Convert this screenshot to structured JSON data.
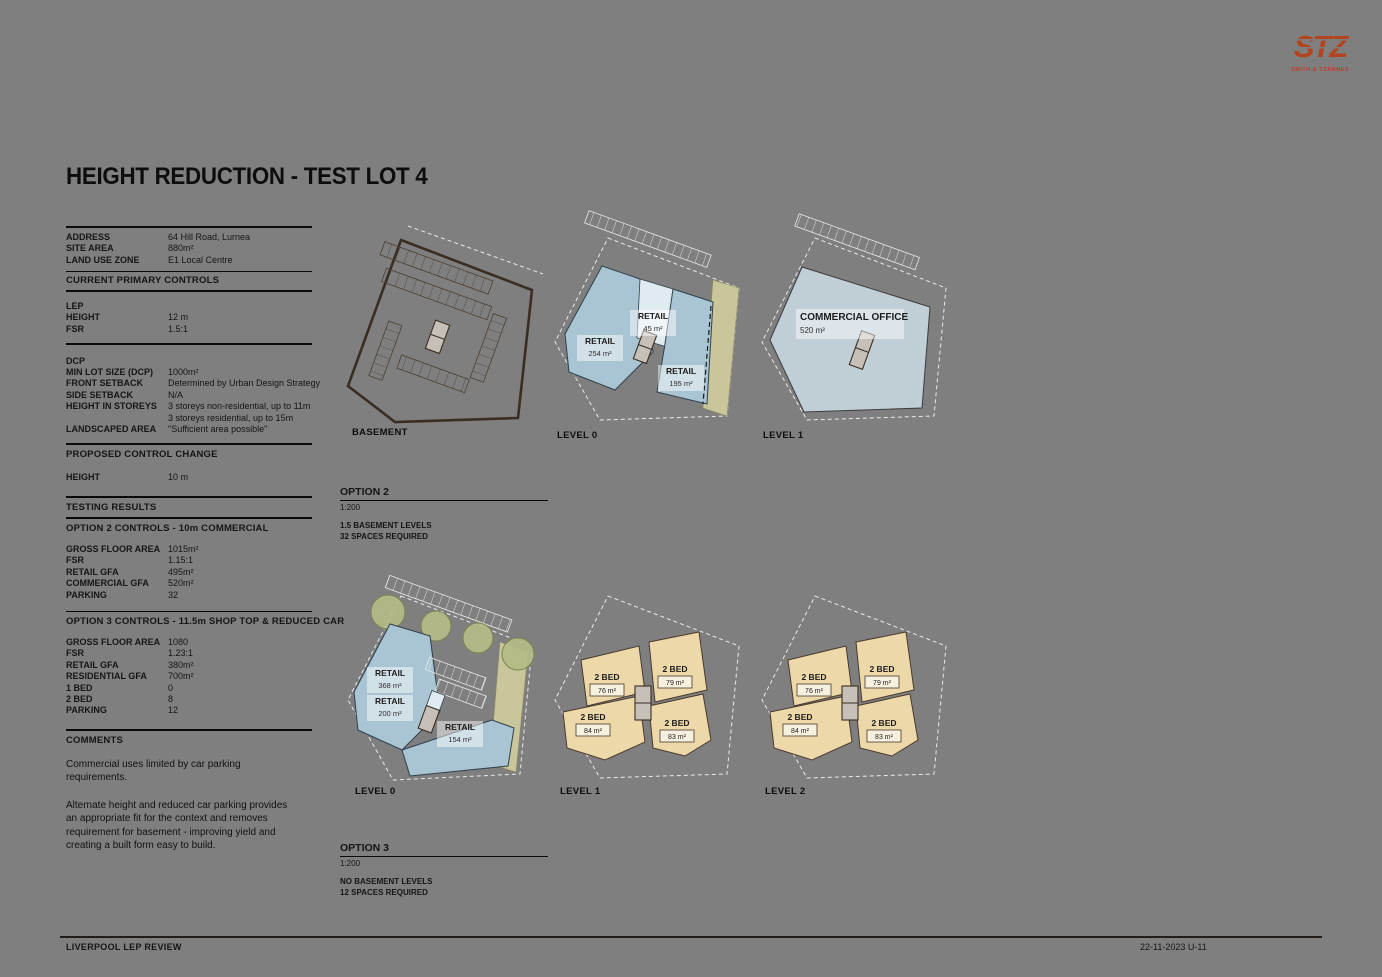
{
  "title": "HEIGHT REDUCTION - TEST LOT 4",
  "logo": {
    "mark": "STZ",
    "subtext": "SMITH & TZANNES"
  },
  "site_details": {
    "rows": [
      {
        "label": "ADDRESS",
        "value": "64 Hill Road, Lurnea"
      },
      {
        "label": "SITE AREA",
        "value": "880m²"
      },
      {
        "label": "LAND USE ZONE",
        "value": "E1 Local Centre"
      }
    ]
  },
  "current_controls": {
    "heading": "CURRENT PRIMARY CONTROLS",
    "lep_heading": "LEP",
    "lep_rows": [
      {
        "label": "HEIGHT",
        "value": "12 m"
      },
      {
        "label": "FSR",
        "value": "1.5:1"
      }
    ],
    "dcp_heading": "DCP",
    "dcp_rows": [
      {
        "label": "MIN LOT SIZE (DCP)",
        "value": "1000m²"
      },
      {
        "label": "FRONT SETBACK",
        "value": "Determined by Urban Design Strategy"
      },
      {
        "label": "SIDE SETBACK",
        "value": "N/A"
      },
      {
        "label": "HEIGHT IN STOREYS",
        "value": "3 storeys non-residential, up to 11m"
      },
      {
        "label": "",
        "value": "3 storeys residential, up to 15m"
      },
      {
        "label": "LANDSCAPED AREA",
        "value": "\"Sufficient area possible\""
      }
    ]
  },
  "proposed_change": {
    "heading": "PROPOSED CONTROL CHANGE",
    "rows": [
      {
        "label": "HEIGHT",
        "value": "10 m"
      }
    ]
  },
  "testing_results_heading": "TESTING RESULTS",
  "option2_controls": {
    "heading": "OPTION 2 CONTROLS - 10m COMMERCIAL",
    "rows": [
      {
        "label": "GROSS FLOOR AREA",
        "value": "1015m²"
      },
      {
        "label": "FSR",
        "value": "1.15:1"
      },
      {
        "label": "RETAIL GFA",
        "value": "495m²"
      },
      {
        "label": "COMMERCIAL GFA",
        "value": "520m²"
      },
      {
        "label": "PARKING",
        "value": "32"
      }
    ]
  },
  "option3_controls": {
    "heading": "OPTION 3 CONTROLS - 11.5m SHOP TOP & REDUCED CAR",
    "rows": [
      {
        "label": "GROSS FLOOR AREA",
        "value": "1080"
      },
      {
        "label": "FSR",
        "value": "1.23:1"
      },
      {
        "label": "RETAIL GFA",
        "value": "380m²"
      },
      {
        "label": "RESIDENTIAL GFA",
        "value": "700m²"
      },
      {
        "label": "1 BED",
        "value": "0"
      },
      {
        "label": "2 BED",
        "value": "8"
      },
      {
        "label": "PARKING",
        "value": "12"
      }
    ]
  },
  "comments": {
    "heading": "COMMENTS",
    "p1": "Commercial uses limited by car parking requirements.",
    "p2": "Alternate height and reduced car parking provides an appropriate fit for the context and removes requirement for basement - improving yield and creating a built form easy to build."
  },
  "option2_plans": {
    "title": "OPTION 2",
    "scale": "1:200",
    "note1": "1.5 BASEMENT LEVELS",
    "note2": "32 SPACES REQUIRED",
    "basement_label": "BASEMENT",
    "level0_label": "LEVEL 0",
    "level1_label": "LEVEL 1",
    "level0_units": [
      {
        "name": "RETAIL",
        "area": "254 m²"
      },
      {
        "name": "RETAIL",
        "area": "45 m²"
      },
      {
        "name": "RETAIL",
        "area": "195 m²"
      }
    ],
    "level1_units": [
      {
        "name": "COMMERCIAL OFFICE",
        "area": "520 m²"
      }
    ]
  },
  "option3_plans": {
    "title": "OPTION 3",
    "scale": "1:200",
    "note1": "NO BASEMENT LEVELS",
    "note2": "12 SPACES REQUIRED",
    "level0_label": "LEVEL 0",
    "level1_label": "LEVEL 1",
    "level2_label": "LEVEL 2",
    "level0_units": [
      {
        "name": "RETAIL",
        "area": "368 m²"
      },
      {
        "name": "RETAIL",
        "area": "200 m²"
      },
      {
        "name": "RETAIL",
        "area": "154 m²"
      }
    ],
    "level1_units": [
      {
        "name": "2 BED",
        "area": "76 m²"
      },
      {
        "name": "2 BED",
        "area": "79 m²"
      },
      {
        "name": "2 BED",
        "area": "84 m²"
      },
      {
        "name": "2 BED",
        "area": "83 m²"
      }
    ],
    "level2_units": [
      {
        "name": "2 BED",
        "area": "76 m²"
      },
      {
        "name": "2 BED",
        "area": "79 m²"
      },
      {
        "name": "2 BED",
        "area": "84 m²"
      },
      {
        "name": "2 BED",
        "area": "83 m²"
      }
    ]
  },
  "footer": {
    "left": "LIVERPOOL LEP REVIEW",
    "right": "22-11-2023  U-11"
  },
  "colors": {
    "background": "#7f7f7f",
    "retail": "#a9c5d3",
    "commercial_office": "#c0ced6",
    "residential": "#ecd8a8",
    "landscape": "#c9c69b",
    "basement_outline": "#3a2d21",
    "logo_accent": "#b5431d"
  }
}
